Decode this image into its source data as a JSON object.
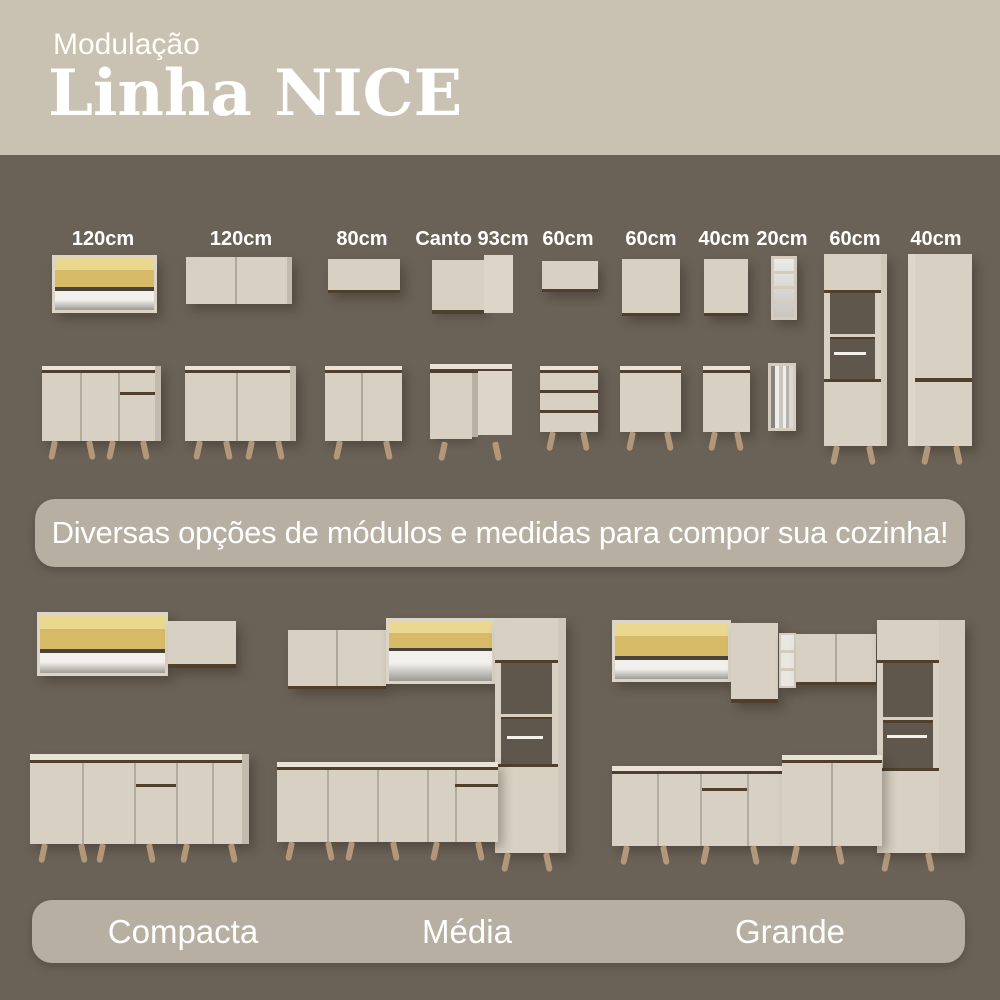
{
  "header": {
    "eyebrow": "Modulação",
    "title": "Linha NICE"
  },
  "modules": {
    "labels": [
      "120cm",
      "120cm",
      "80cm",
      "Canto 93cm",
      "60cm",
      "60cm",
      "40cm",
      "20cm",
      "60cm",
      "40cm"
    ]
  },
  "banner": {
    "text": "Diversas opções de módulos e medidas para compor sua cozinha!"
  },
  "kitchen_sizes": {
    "labels": [
      "Compacta",
      "Média",
      "Grande"
    ]
  },
  "colors": {
    "background": "#6b6257",
    "header_bg": "#c9c2b3",
    "banner_bg": "#b7afa1",
    "cabinet": "#d8d1c3",
    "cabinet_side": "#c2bbad",
    "edge_dark": "#4f3f2c",
    "glass": "#d6ba67",
    "legs": "#b2977a",
    "text": "#ffffff"
  }
}
